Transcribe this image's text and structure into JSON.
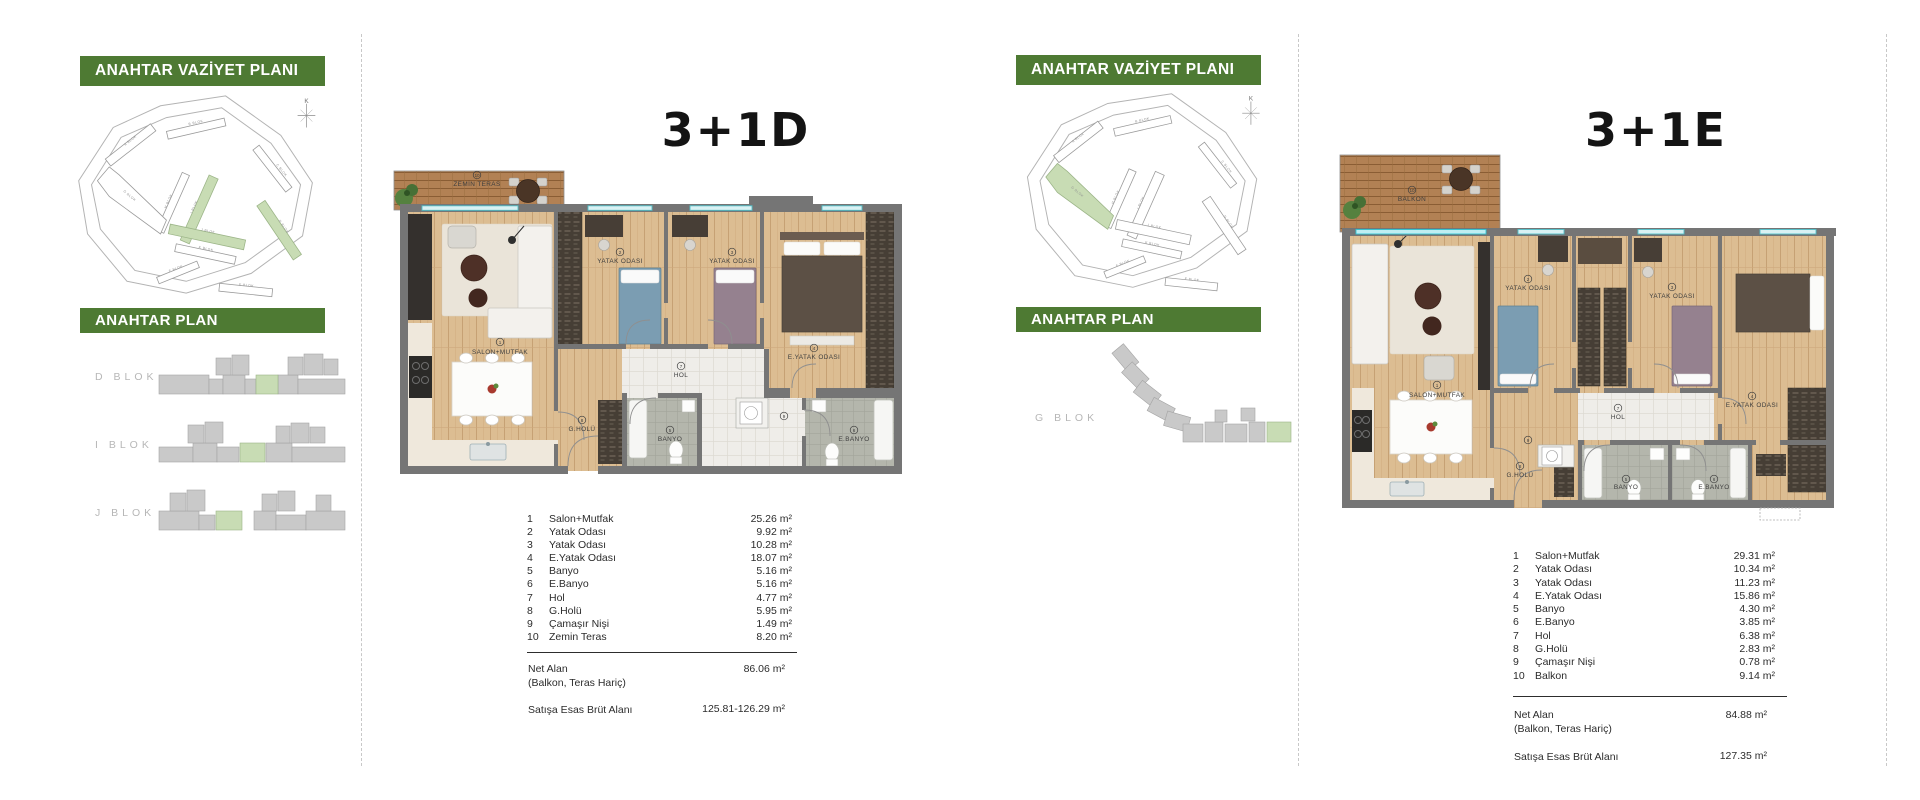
{
  "compass_letter": "K",
  "site_block_labels": {
    "a": "A BLOK",
    "b": "B BLOK",
    "c": "C BLOK",
    "d": "D BLOK",
    "e": "E BLOK",
    "f": "F BLOK",
    "g": "G BLOK",
    "h": "H BLOK",
    "i": "I BLOK",
    "j": "J BLOK",
    "k": "K BLOK"
  },
  "panels": [
    {
      "vaziyet_header": "ANAHTAR VAZİYET PLANI",
      "plan_header": "ANAHTAR PLAN",
      "unit_title": "3+1D",
      "block_labels": [
        "D BLOK",
        "I BLOK",
        "J BLOK"
      ],
      "rooms": [
        {
          "no": "1",
          "name": "Salon+Mutfak",
          "area": "25.26 m²"
        },
        {
          "no": "2",
          "name": "Yatak Odası",
          "area": "9.92 m²"
        },
        {
          "no": "3",
          "name": "Yatak Odası",
          "area": "10.28 m²"
        },
        {
          "no": "4",
          "name": "E.Yatak Odası",
          "area": "18.07 m²"
        },
        {
          "no": "5",
          "name": "Banyo",
          "area": "5.16 m²"
        },
        {
          "no": "6",
          "name": "E.Banyo",
          "area": "5.16 m²"
        },
        {
          "no": "7",
          "name": "Hol",
          "area": "4.77 m²"
        },
        {
          "no": "8",
          "name": "G.Holü",
          "area": "5.95 m²"
        },
        {
          "no": "9",
          "name": "Çamaşır Nişi",
          "area": "1.49 m²"
        },
        {
          "no": "10",
          "name": "Zemin Teras",
          "area": "8.20 m²"
        }
      ],
      "summary": {
        "net_label": "Net Alan",
        "net_note": "(Balkon, Teras Hariç)",
        "net_value": "86.06 m²",
        "gross_label": "Satışa Esas Brüt Alanı",
        "gross_value": "125.81-126.29 m²"
      },
      "plan_labels": {
        "salon": "SALON+MUTFAK",
        "bed": "YATAK ODASI",
        "master": "E.YATAK ODASI",
        "bath": "BANYO",
        "masterbath": "E.BANYO",
        "hall": "HOL",
        "entry": "G.HOLÜ",
        "outdoor": "ZEMİN TERAS"
      }
    },
    {
      "vaziyet_header": "ANAHTAR VAZİYET PLANI",
      "plan_header": "ANAHTAR PLAN",
      "unit_title": "3+1E",
      "block_labels": [
        "G BLOK"
      ],
      "rooms": [
        {
          "no": "1",
          "name": "Salon+Mutfak",
          "area": "29.31 m²"
        },
        {
          "no": "2",
          "name": "Yatak Odası",
          "area": "10.34 m²"
        },
        {
          "no": "3",
          "name": "Yatak Odası",
          "area": "11.23 m²"
        },
        {
          "no": "4",
          "name": "E.Yatak Odası",
          "area": "15.86 m²"
        },
        {
          "no": "5",
          "name": "Banyo",
          "area": "4.30 m²"
        },
        {
          "no": "6",
          "name": "E.Banyo",
          "area": "3.85 m²"
        },
        {
          "no": "7",
          "name": "Hol",
          "area": "6.38 m²"
        },
        {
          "no": "8",
          "name": "G.Holü",
          "area": "2.83 m²"
        },
        {
          "no": "9",
          "name": "Çamaşır Nişi",
          "area": "0.78 m²"
        },
        {
          "no": "10",
          "name": "Balkon",
          "area": "9.14 m²"
        }
      ],
      "summary": {
        "net_label": "Net Alan",
        "net_note": "(Balkon, Teras Hariç)",
        "net_value": "84.88 m²",
        "gross_label": "Satışa Esas Brüt Alanı",
        "gross_value": "127.35 m²"
      },
      "plan_labels": {
        "salon": "SALON+MUTFAK",
        "bed": "YATAK ODASI",
        "master": "E.YATAK ODASI",
        "bath": "BANYO",
        "masterbath": "E.BANYO",
        "hall": "HOL",
        "entry": "G.HOLÜ",
        "outdoor": "BALKON"
      }
    }
  ]
}
